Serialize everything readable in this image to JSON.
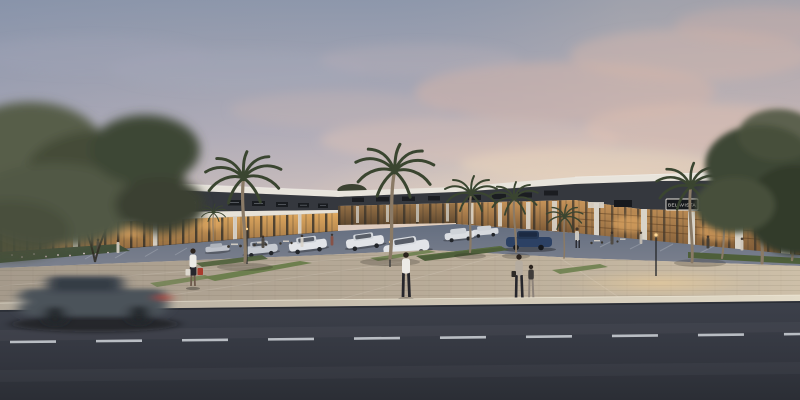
{
  "meta": {
    "title": "Dusk architectural rendering of a single-story shopping strip mall"
  },
  "scene": {
    "description": "Photorealistic dusk rendering of a modern U-shaped strip mall with illuminated glass storefronts, dark fascia sign bands, white awnings, palm trees, a parking lot with parked cars, pedestrians on a paved plaza, and a motion-blurred car passing on the foreground road under a pink-and-blue sunset sky",
    "time_of_day": "dusk"
  },
  "signs": {
    "doce_pao_large": "DOCE PÃO",
    "doce_pao_small": "DOCE PÃO",
    "belavista": "BELAVISTA"
  },
  "objects": {
    "palm_tree_count": 10,
    "parked_car_count": 9,
    "pedestrians": [
      "woman carrying shopping bags",
      "man walking in plaza",
      "adult holding child's hand",
      "child"
    ],
    "foreground": [
      "motion-blurred passing car",
      "asphalt road with dashed center line"
    ]
  },
  "palette": {
    "sky_top": "#8d97ab",
    "sky_mid": "#b3aeb9",
    "sky_low": "#d8c7bf",
    "sky_horizon": "#f7ead4",
    "cloud_pink": "#d5b5aa",
    "cloud_cream": "#ecd5bc",
    "cloud_gray": "#a6aabb",
    "roof_white": "#e8e4dc",
    "sign_band": "#35383e",
    "sign_plate": "#17191d",
    "sign_text": "#e9e6df",
    "awning": "#e7e2d8",
    "column_light": "#d9d3c8",
    "mullion": "#2b2a27",
    "storefront_glow_top": "#e0a95f",
    "storefront_glow_bottom": "#7d5a38",
    "parking_top": "#646e80",
    "parking_bottom": "#7c818e",
    "car_white": "#e2e4e8",
    "car_silver": "#c6cad1",
    "car_blue": "#2c4164",
    "hedge_green": "#4e5f3a",
    "grass_green": "#6d7f4e",
    "flower_bed": "#42503a",
    "palm_green": "#3a4530",
    "palm_trunk": "#8a7a66",
    "tree_dark": "#3e4734",
    "tree_light": "#555c45",
    "plaza_left": "#a59a8b",
    "plaza_right": "#cdbfa8",
    "curb_left": "#b2a99a",
    "curb_right": "#e3dbc8",
    "road_top": "#3d414b",
    "road_bottom": "#2b2e35",
    "lane_dash": "#c8ccd2",
    "blur_car": "#4b525a",
    "tail_light": "#b24034",
    "lamp_glow": "#ffd896",
    "skin": "#6e5a4c",
    "shirt_white": "#eceae6",
    "pants_dark": "#26262c",
    "bag_red": "#a93a2c",
    "hair_dark": "#2c241e",
    "adult_top": "#b5aca0",
    "child_top": "#3f3c3a"
  }
}
